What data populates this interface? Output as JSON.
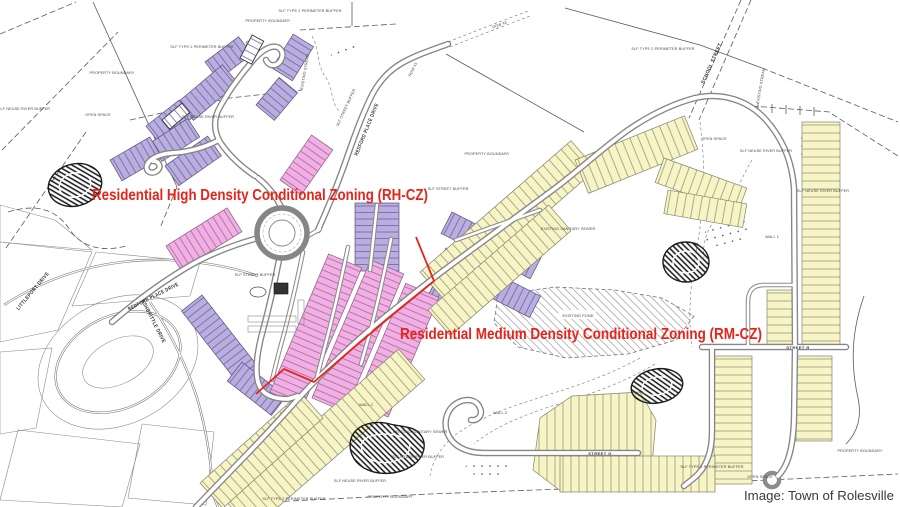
{
  "map": {
    "attribution": "Image: Town of Rolesville",
    "zones": {
      "high_density": "Residential High Density Conditional Zoning (RH-CZ)",
      "medium_density": "Residential Medium Density Conditional Zoning (RM-CZ)"
    },
    "streets": {
      "school_street": "SCHOOL STREET",
      "littleport_drive": "LITTLEPORT DRIVE",
      "ashbrittle_drive": "ASHBRITTLE DRIVE",
      "redford_place_drive": "REDFORD PLACE DRIVE",
      "street_g": "STREET G",
      "street_h": "STREET H"
    },
    "annotations": {
      "property_boundary": "PROPERTY BOUNDARY",
      "open_space": "OPEN SPACE",
      "type2_perimeter_buffer": "SLF TYPE 2 PERIMETER BUFFER",
      "neuse_river_buffer": "SLF NEUSE RIVER BUFFER",
      "street_buffer": "SLF STREET BUFFER",
      "existing_pond": "EXISTING POND",
      "existing_stream": "EXISTING STREAM",
      "existing_sanitary_sewer": "EXISTING SANITARY SEWER",
      "row_43": "ROW 43",
      "wall_1": "WALL 1",
      "wall_2": "WALL 2",
      "wall_3": "WALL 3"
    },
    "colors": {
      "rh_lot": "#b9aede",
      "townhome_lot": "#f1b0e4",
      "rm_lot": "#f7f4c5",
      "zone_line": "#e8231a",
      "red_label": "#e8231a",
      "attribution_text": "#3a3a3a"
    }
  }
}
